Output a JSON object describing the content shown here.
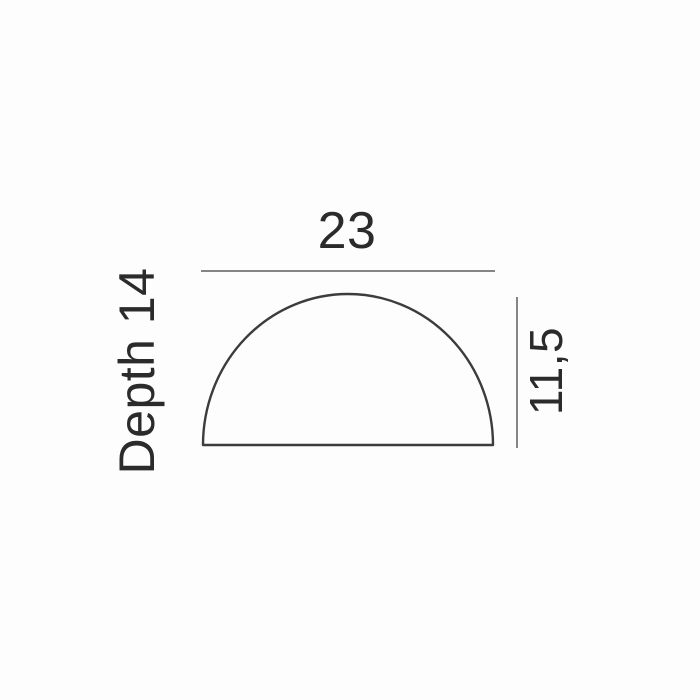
{
  "diagram": {
    "type": "product-dimension-drawing",
    "shape": "semicircular-dome",
    "width_label": "23",
    "height_label": "11,5",
    "depth_label": "Depth 14",
    "dimensions": {
      "width": 23,
      "height": 11.5,
      "depth": 14
    },
    "colors": {
      "background": "#fdfdfd",
      "text": "#2b2b2b",
      "dimension_line": "#858585",
      "outline": "#3c3c3c"
    }
  }
}
